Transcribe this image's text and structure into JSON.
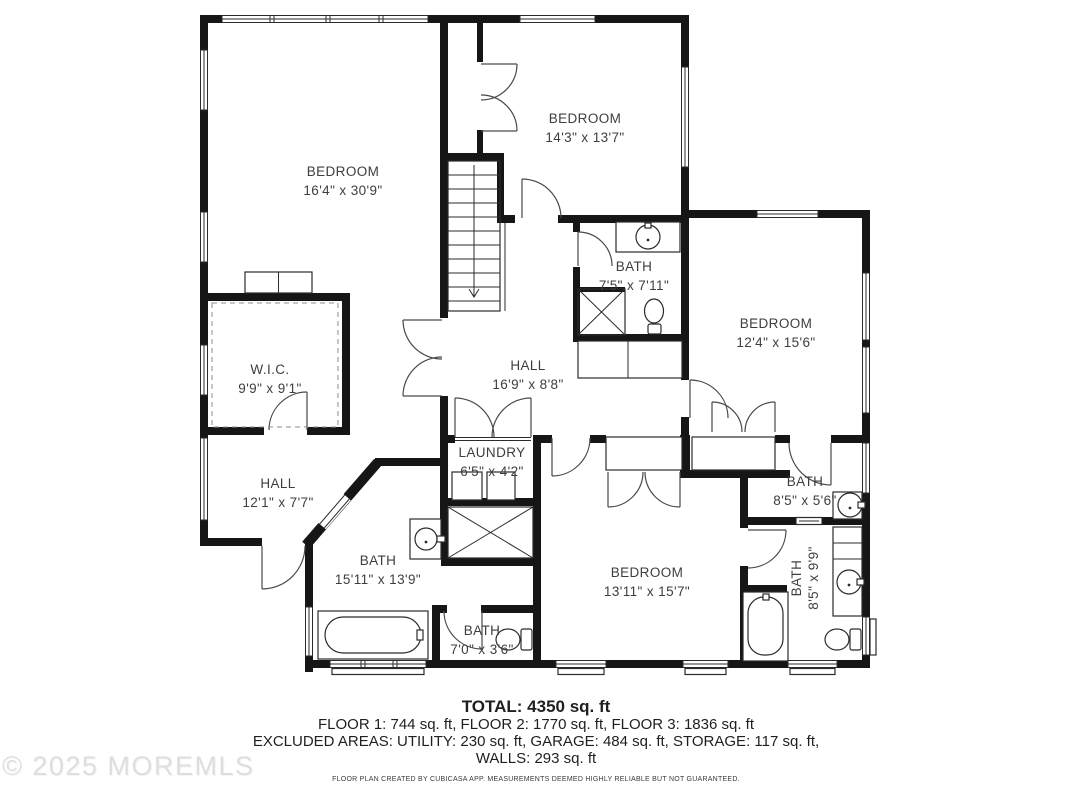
{
  "floor_plan": {
    "rooms": [
      {
        "id": "bedroom-1",
        "name": "BEDROOM",
        "dims": "16'4\" x 30'9\""
      },
      {
        "id": "bedroom-2",
        "name": "BEDROOM",
        "dims": "14'3\" x 13'7\""
      },
      {
        "id": "bath-1",
        "name": "BATH",
        "dims": "7'5\" x 7'11\""
      },
      {
        "id": "bedroom-3",
        "name": "BEDROOM",
        "dims": "12'4\" x 15'6\""
      },
      {
        "id": "wic",
        "name": "W.I.C.",
        "dims": "9'9\" x 9'1\""
      },
      {
        "id": "hall-1",
        "name": "HALL",
        "dims": "16'9\" x 8'8\""
      },
      {
        "id": "laundry",
        "name": "LAUNDRY",
        "dims": "6'5\" x 4'2\""
      },
      {
        "id": "hall-2",
        "name": "HALL",
        "dims": "12'1\" x 7'7\""
      },
      {
        "id": "bath-2",
        "name": "BATH",
        "dims": "15'11\" x 13'9\""
      },
      {
        "id": "bedroom-4",
        "name": "BEDROOM",
        "dims": "13'11\" x 15'7\""
      },
      {
        "id": "bath-3",
        "name": "BATH",
        "dims": "8'5\" x 5'6\""
      },
      {
        "id": "bath-4",
        "name": "BATH",
        "dims": "8'5\" x 9'9\""
      },
      {
        "id": "bath-5",
        "name": "BATH",
        "dims": "7'0\" x 3'6\""
      }
    ],
    "summary": {
      "total": "TOTAL: 4350 sq. ft",
      "floors": "FLOOR 1: 744 sq. ft, FLOOR 2: 1770 sq. ft, FLOOR 3: 1836 sq. ft",
      "excluded": "EXCLUDED AREAS: UTILITY: 230 sq. ft, GARAGE: 484 sq. ft, STORAGE: 117 sq. ft,",
      "walls": "WALLS: 293 sq. ft",
      "disclaimer": "FLOOR PLAN CREATED BY CUBICASA APP. MEASUREMENTS DEEMED HIGHLY RELIABLE BUT NOT GUARANTEED."
    },
    "watermark": "© 2025 MOREMLS"
  }
}
